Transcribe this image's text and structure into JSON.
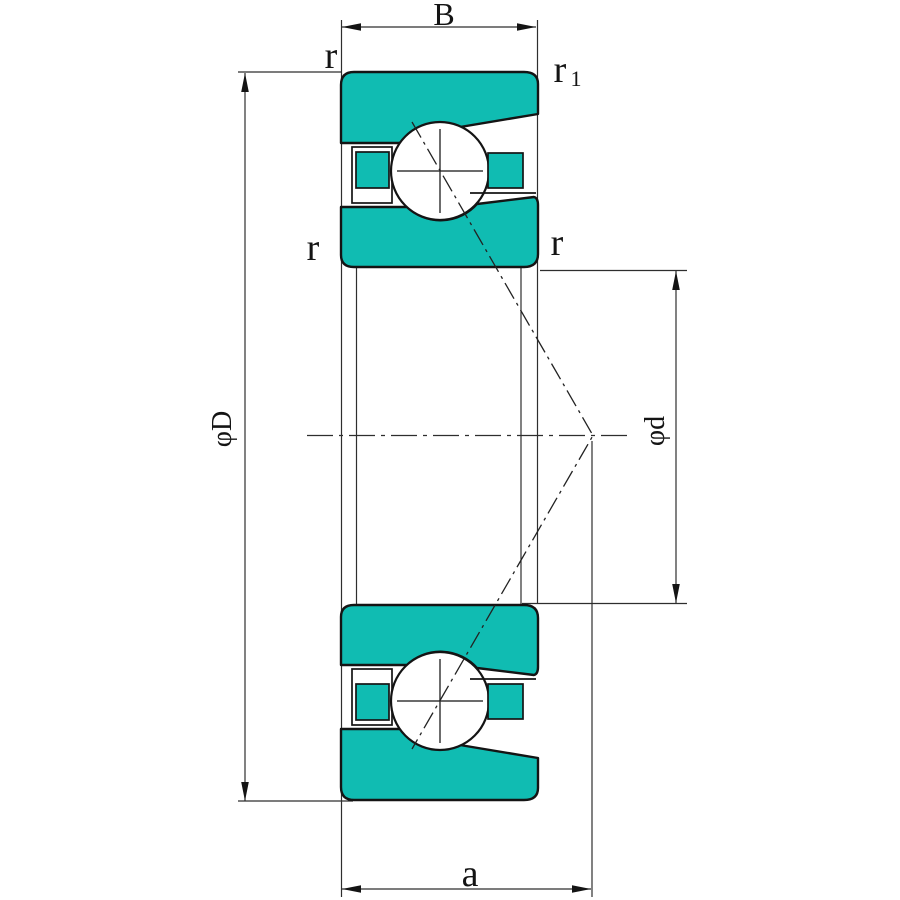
{
  "drawing": {
    "title": "Angular contact ball bearing — dimensioned cross-section",
    "colors": {
      "ring_fill": "#10bcb2",
      "outline": "#141414",
      "dim_line": "#2e2e2e"
    },
    "labels": {
      "width": "B",
      "outer_ring_chamfer": "r",
      "front_face_chamfer_base": "r",
      "front_face_chamfer_sub": "1",
      "outer_ring_chamfer_left": "r",
      "inner_ring_chamfer_right": "r",
      "outer_diameter": "φD",
      "bore_diameter": "φd",
      "load_center_distance": "a"
    }
  }
}
